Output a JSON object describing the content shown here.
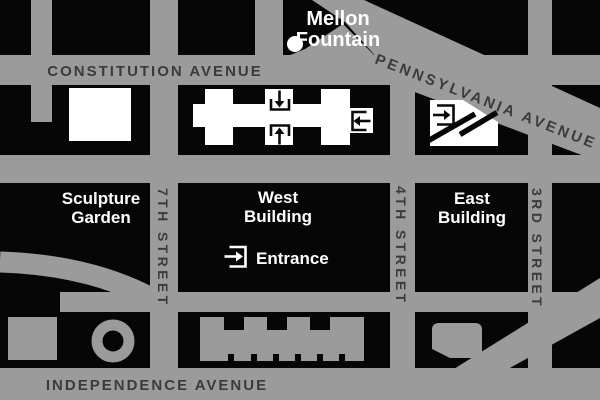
{
  "map": {
    "title": "National Gallery of Art area map",
    "labels": {
      "mellon_fountain": {
        "line1": "Mellon",
        "line2": "Fountain"
      },
      "constitution_avenue": "CONSTITUTION AVENUE",
      "pennsylvania_avenue": "PENNSYLVANIA AVENUE",
      "independence_avenue": "INDEPENDENCE AVENUE",
      "seventh_street": "7TH STREET",
      "fourth_street": "4TH STREET",
      "third_street": "3RD STREET",
      "sculpture_garden": {
        "line1": "Sculpture",
        "line2": "Garden"
      },
      "west_building": {
        "line1": "West",
        "line2": "Building"
      },
      "east_building": {
        "line1": "East",
        "line2": "Building"
      },
      "entrance_legend": "Entrance"
    },
    "icons": {
      "entrance_icon": "arrow-into-bracket entry marker",
      "fountain_dot": "white dot marker"
    },
    "colors": {
      "street_gray": "#9b9b9b",
      "block_black": "#060606",
      "building_white": "#ffffff",
      "street_label_dark": "#3b3b3d",
      "label_white": "#ffffff"
    }
  }
}
